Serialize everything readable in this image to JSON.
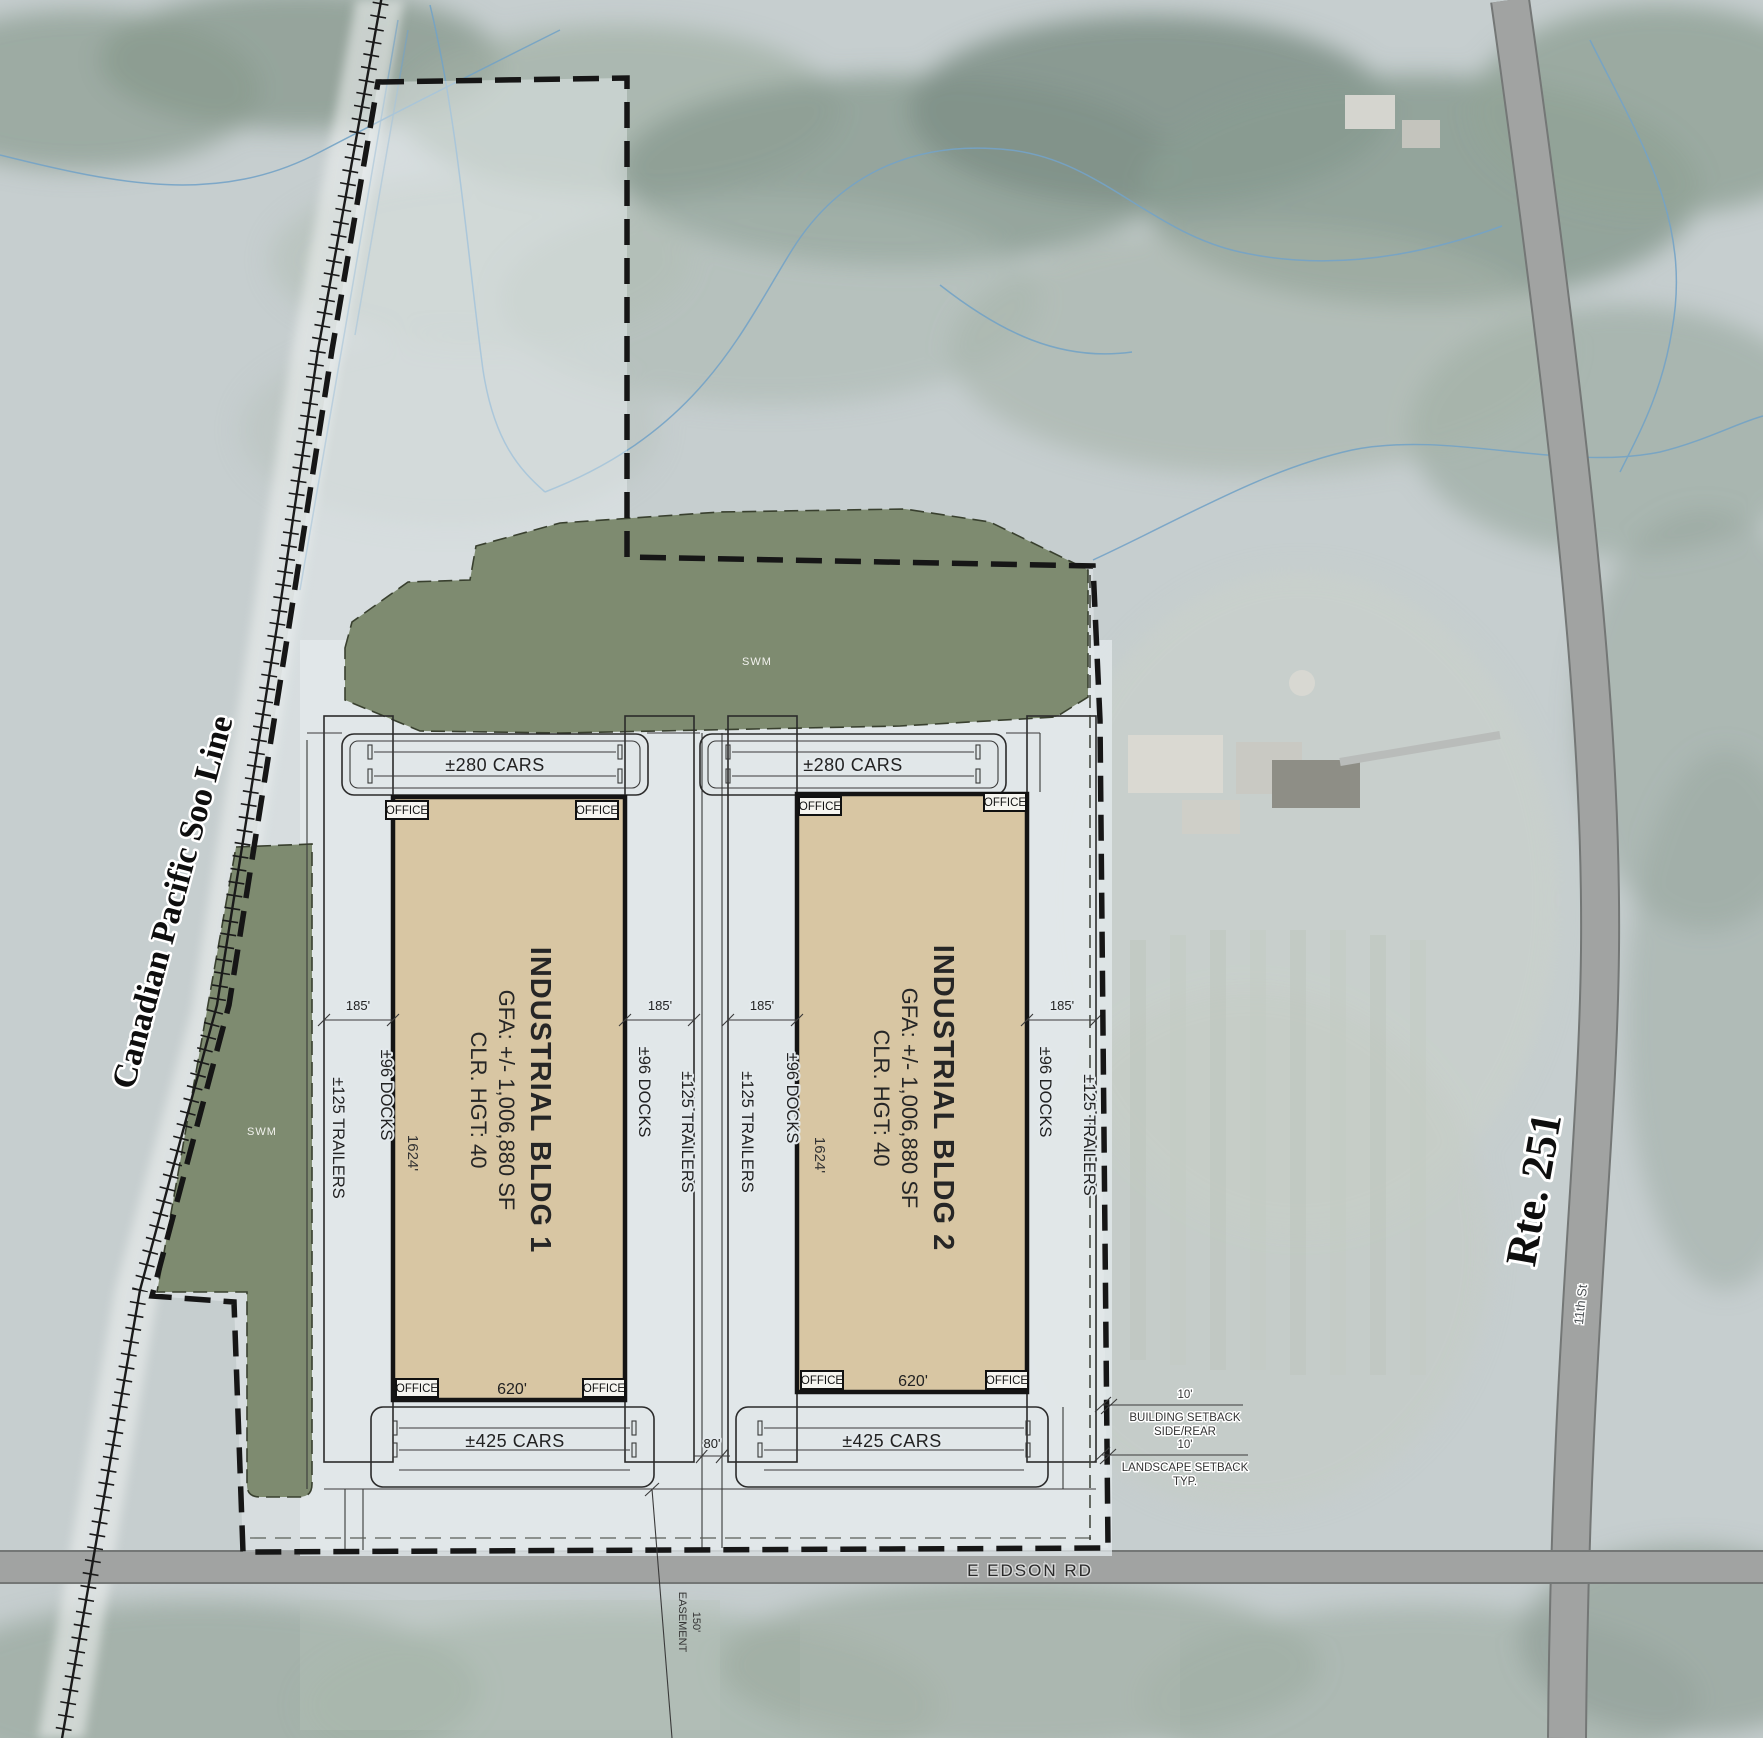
{
  "labels": {
    "railroad": "Canadian Pacific Soo Line",
    "route": "Rte. 251",
    "street": "11th St",
    "road": "E EDSON RD",
    "swm": "SWM",
    "office": "OFFICE",
    "parking_top": "±280 CARS",
    "parking_bottom": "±425 CARS",
    "docks": "±96 DOCKS",
    "trailers": "±125 TRAILERS",
    "court_depth": "185'",
    "drive_width": "80'",
    "easement_line1": "150'",
    "easement_line2": "EASEMENT"
  },
  "buildings": [
    {
      "name": "INDUSTRIAL BLDG 1",
      "gfa": "GFA: +/- 1,006,880 SF",
      "clr": "CLR. HGT: 40",
      "width": "620'",
      "length": "1624'"
    },
    {
      "name": "INDUSTRIAL BLDG 2",
      "gfa": "GFA: +/- 1,006,880 SF",
      "clr": "CLR. HGT: 40",
      "width": "620'",
      "length": "1624'"
    }
  ],
  "setbacks": {
    "building": {
      "dim": "10'",
      "line1": "BUILDING SETBACK",
      "line2": "SIDE/REAR"
    },
    "landscape": {
      "dim": "10'",
      "line1": "LANDSCAPE SETBACK",
      "line2": "TYP."
    }
  },
  "colors": {
    "swm_green": "#7e8b70",
    "building_tan": "#d8c6a3",
    "pavement": "#e3e9ec",
    "boundary_black": "#1a1a1a",
    "road_gray": "#a1a3a2",
    "stream_blue": "#74a3c6"
  }
}
